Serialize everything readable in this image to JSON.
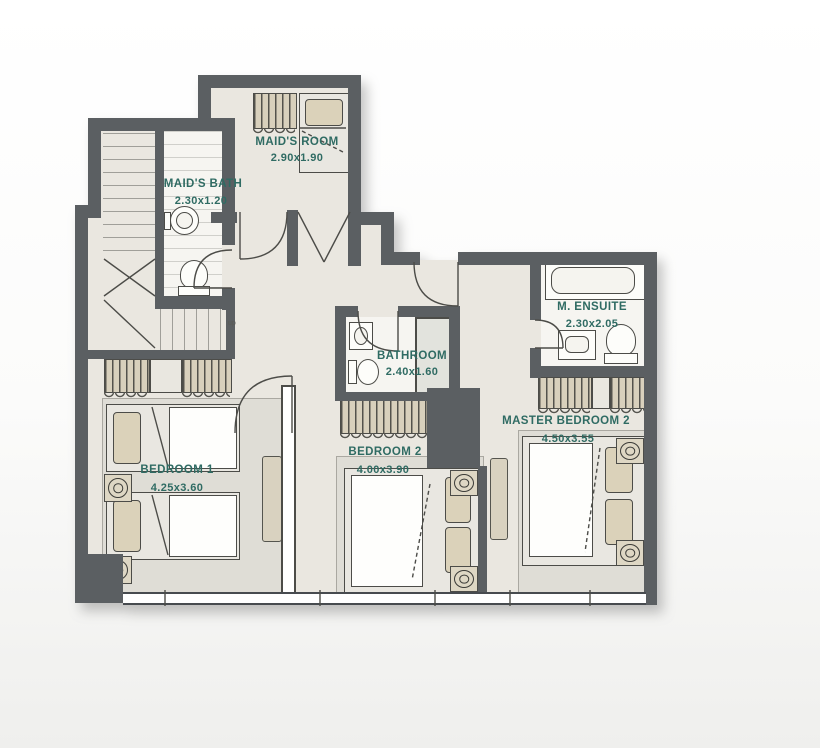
{
  "plan": {
    "stairs_label": "up",
    "rooms": [
      {
        "id": "maids-room",
        "name": "MAID'S ROOM",
        "dims": "2.90x1.90"
      },
      {
        "id": "maids-bath",
        "name": "MAID'S BATH",
        "dims": "2.30x1.20"
      },
      {
        "id": "bathroom",
        "name": "BATHROOM",
        "dims": "2.40x1.60"
      },
      {
        "id": "m-ensuite",
        "name": "M. ENSUITE",
        "dims": "2.30x2.05"
      },
      {
        "id": "bedroom-1",
        "name": "BEDROOM 1",
        "dims": "4.25x3.60"
      },
      {
        "id": "bedroom-2",
        "name": "BEDROOM 2",
        "dims": "4.00x3.90"
      },
      {
        "id": "master-bedroom-2",
        "name": "MASTER BEDROOM 2",
        "dims": "4.50x3.55"
      }
    ],
    "colors": {
      "wall": "#5b5f62",
      "floor": "#eae7e0",
      "accent_text": "#2f6b63",
      "furniture": "#d8d0bc",
      "rug": "#dfddd6"
    }
  }
}
